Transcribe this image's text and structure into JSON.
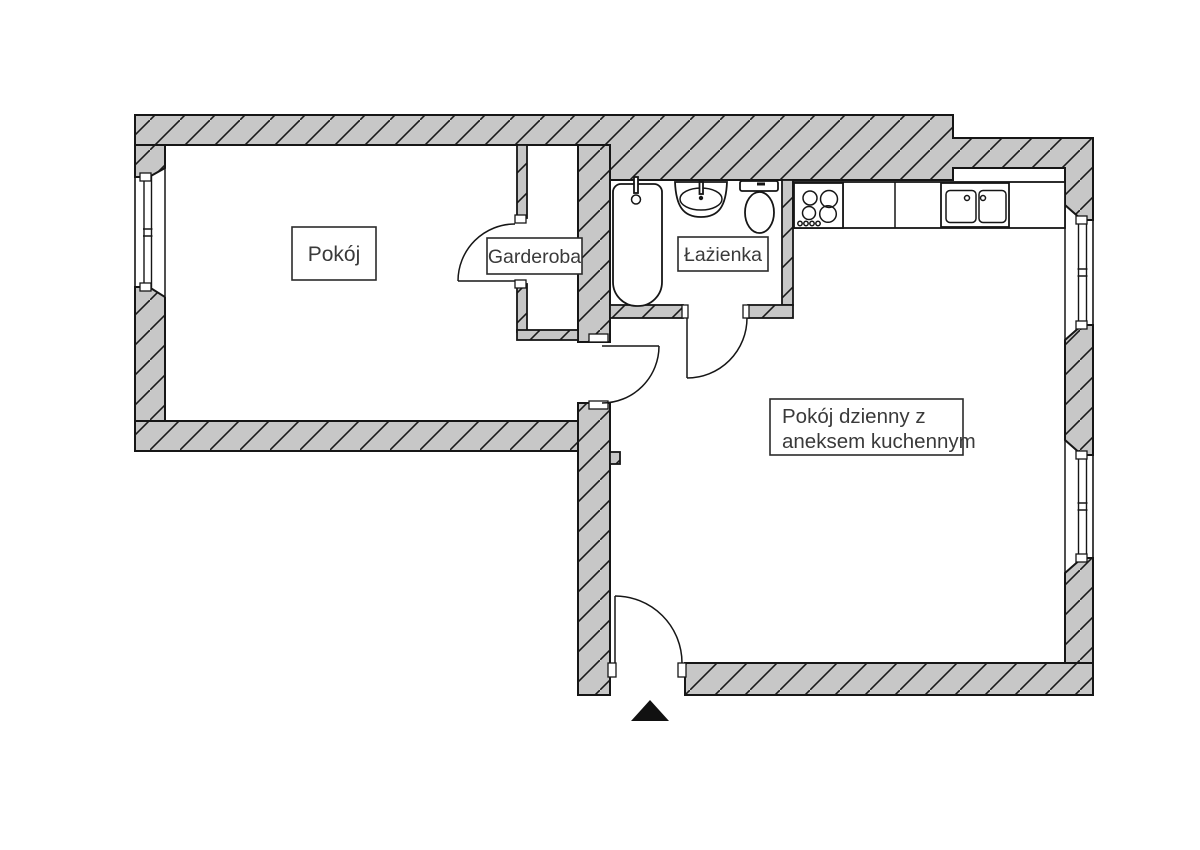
{
  "labels": {
    "pokoj": "Pokój",
    "garderoba": "Garderoba",
    "lazienka": "Łażienka",
    "living_line1": "Pokój dzienny z",
    "living_line2": "aneksem kuchennym"
  },
  "colors": {
    "wall_fill": "#c7c7c7",
    "line": "#161616",
    "arrow": "#111111",
    "label_text": "#3a3a3a",
    "background": "#ffffff"
  },
  "plan": {
    "doors": [
      "garderoba-door",
      "pokoj-door",
      "bathroom-door",
      "entrance-door"
    ],
    "windows": [
      "west-window",
      "east-window-upper",
      "east-window-lower"
    ],
    "bathroom_fixtures": [
      "bathtub",
      "washbasin",
      "toilet"
    ],
    "kitchen_fixtures": [
      "stove-hob",
      "double-sink",
      "counter"
    ],
    "entrance_marker": "black-triangle"
  }
}
